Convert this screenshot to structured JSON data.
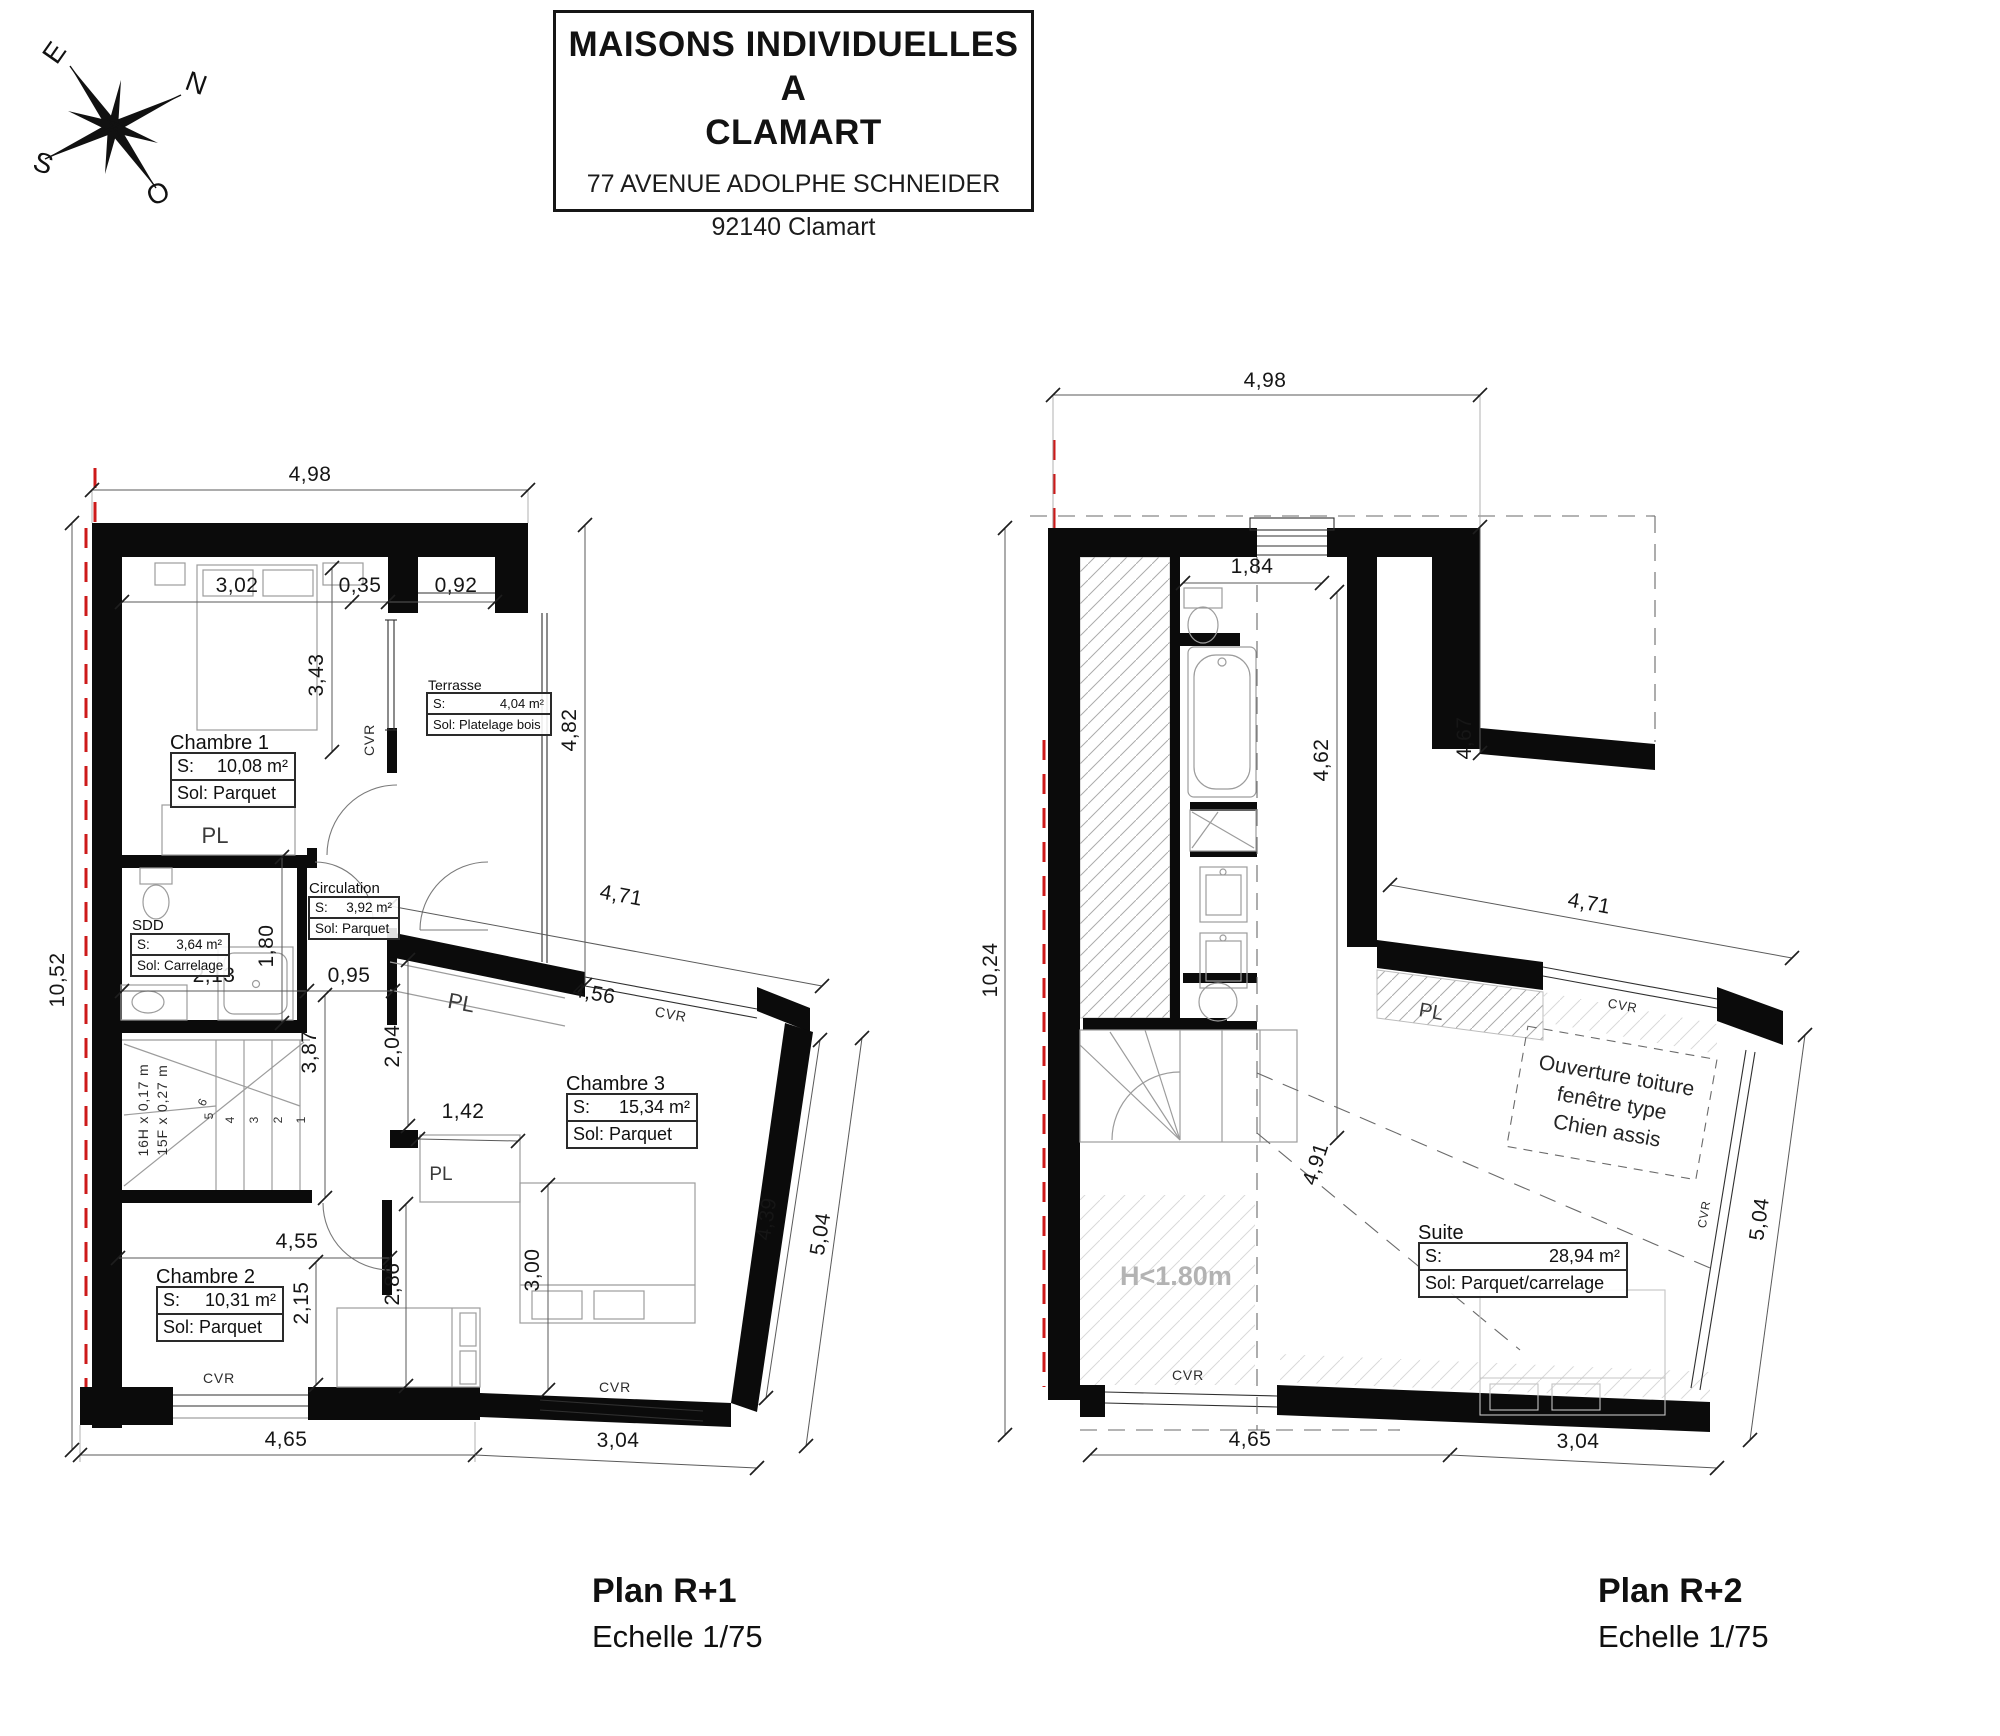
{
  "title_block": {
    "title_line1": "MAISONS INDIVIDUELLES A",
    "title_line2": "CLAMART",
    "address": "77 AVENUE ADOLPHE SCHNEIDER",
    "city": "92140 Clamart"
  },
  "compass": {
    "e": "E",
    "n": "N",
    "s": "S",
    "o": "O"
  },
  "plan_r1": {
    "caption": {
      "title": "Plan R+1",
      "scale": "Echelle 1/75"
    },
    "rooms": {
      "chambre1": {
        "name": "Chambre 1",
        "s_label": "S:",
        "s_value": "10,08 m²",
        "sol": "Sol: Parquet"
      },
      "chambre2": {
        "name": "Chambre 2",
        "s_label": "S:",
        "s_value": "10,31 m²",
        "sol": "Sol: Parquet"
      },
      "chambre3": {
        "name": "Chambre 3",
        "s_label": "S:",
        "s_value": "15,34 m²",
        "sol": "Sol: Parquet"
      },
      "sdd": {
        "name": "SDD",
        "s_label": "S:",
        "s_value": "3,64 m²",
        "sol": "Sol: Carrelage"
      },
      "circulation": {
        "name": "Circulation",
        "s_label": "S:",
        "s_value": "3,92 m²",
        "sol": "Sol: Parquet"
      },
      "terrasse": {
        "name": "Terrasse",
        "s_label": "S:",
        "s_value": "4,04 m²",
        "sol": "Sol: Platelage bois"
      }
    },
    "labels": {
      "pl1": "PL",
      "pl2": "PL",
      "pl3": "PL",
      "cvr1": "CVR",
      "cvr2": "CVR",
      "cvr3": "CVR",
      "cvr4": "CVR",
      "stairs_line1": "16H x 0,17 m",
      "stairs_line2": "15F x 0,27 m",
      "steps": {
        "s1": "1",
        "s2": "2",
        "s3": "3",
        "s4": "4",
        "s5": "5",
        "s6": "6"
      }
    },
    "dims": {
      "top": "4,98",
      "left": "10,52",
      "w_bed": "3,02",
      "w_035": "0,35",
      "w_092": "0,92",
      "h_343": "3,43",
      "h_482": "4,82",
      "h_180": "1,80",
      "w_213": "2,13",
      "w_095": "0,95",
      "h_387": "3,87",
      "h_204": "2,04",
      "slant_471": "4,71",
      "slant_456": "4,56",
      "w_142": "1,42",
      "w_455": "4,55",
      "h_215": "2,15",
      "h_286": "2,86",
      "h_300": "3,00",
      "slant_439": "4,39",
      "slant_504": "5,04",
      "bottom_465": "4,65",
      "bottom_304": "3,04"
    }
  },
  "plan_r2": {
    "caption": {
      "title": "Plan R+2",
      "scale": "Echelle 1/75"
    },
    "rooms": {
      "suite": {
        "name": "Suite",
        "s_label": "S:",
        "s_value": "28,94 m²",
        "sol": "Sol: Parquet/carrelage"
      }
    },
    "labels": {
      "pl": "PL",
      "cvr_top": "CVR",
      "cvr_right": "CVR",
      "cvr_bottom": "CVR",
      "height_note": "H<1.80m",
      "ouverture_line1": "Ouverture toiture",
      "ouverture_line2": "fenêtre type",
      "ouverture_line3": "Chien assis"
    },
    "dims": {
      "top": "4,98",
      "left": "10,24",
      "w_184": "1,84",
      "h_462": "4,62",
      "h_467": "4,67",
      "slant_471": "4,71",
      "diag_491": "4,91",
      "slant_504": "5,04",
      "bottom_465": "4,65",
      "bottom_304": "3,04"
    }
  }
}
